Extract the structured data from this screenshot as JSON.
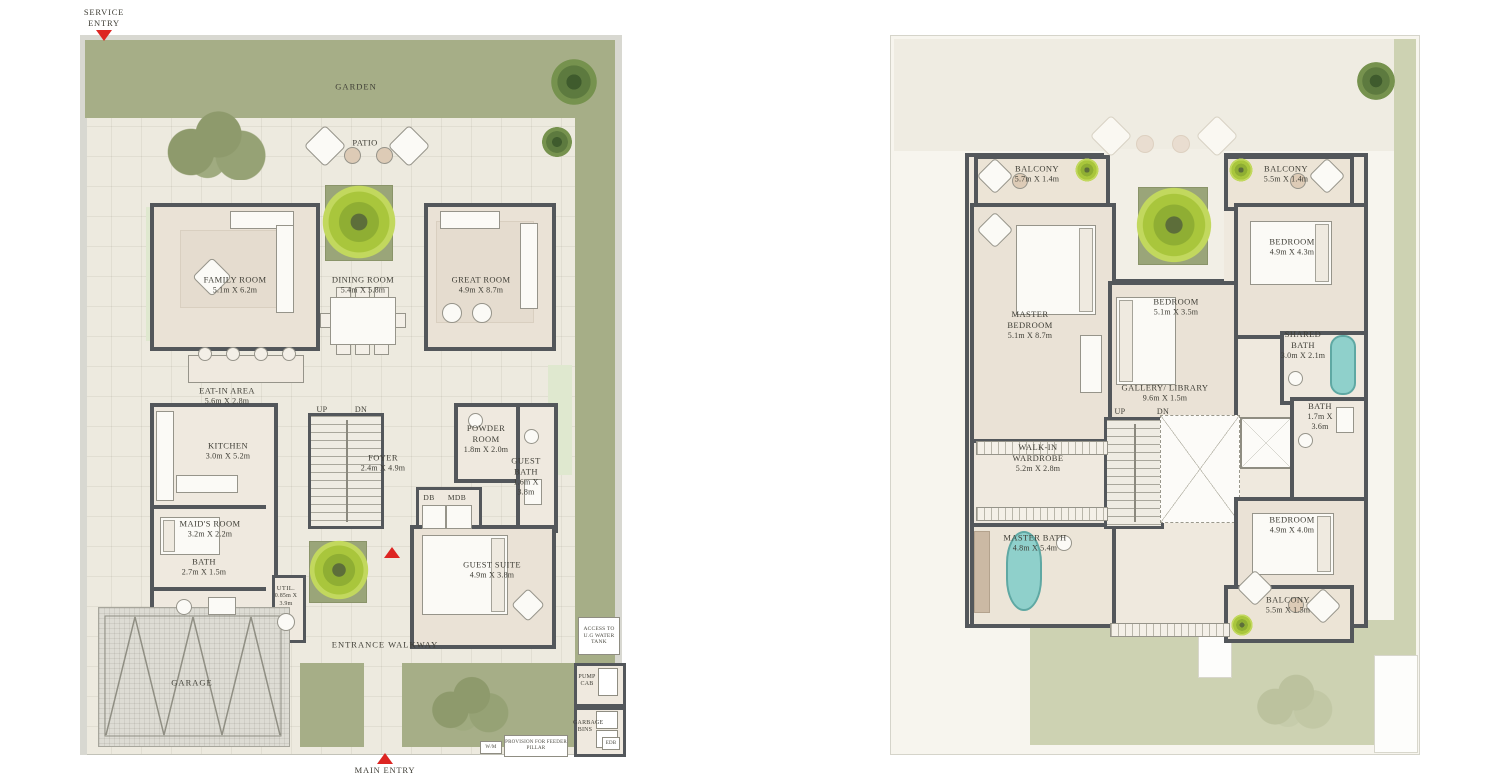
{
  "palette": {
    "garden_green": "#a6ae87",
    "pale_green": "#cdd2b2",
    "window_mint": "#dfe8cf",
    "floor_cream": "#edeadf",
    "room_beige": "#eae2d6",
    "wall_dark": "#53575b",
    "entry_red": "#dd2522",
    "tub_teal": "#8fd0cb",
    "tree_bright": "#a9c63c",
    "text_ink": "#3e3d35"
  },
  "ground_floor": {
    "entries": {
      "service": "SERVICE ENTRY",
      "main": "MAIN ENTRY"
    },
    "zones": {
      "garden": "GARDEN",
      "patio": "PATIO",
      "walkway": "ENTRANCE WALKWAY",
      "garage": "GARAGE"
    },
    "stairs": {
      "up": "UP",
      "dn": "DN"
    },
    "panels": {
      "db": "DB",
      "mdb": "MDB"
    },
    "services": {
      "water_tank": "ACCESS TO U.G WATER TANK",
      "pump": "PUMP CAB",
      "garbage": "GARBAGE BINS",
      "feeder": "PROVISION FOR FEEDER PILLAR",
      "wm": "W/M",
      "edb": "EDB"
    },
    "rooms": [
      {
        "name": "FAMILY ROOM",
        "dims": "5.1m X 6.2m"
      },
      {
        "name": "DINING ROOM",
        "dims": "5.4m X 5.8m"
      },
      {
        "name": "GREAT ROOM",
        "dims": "4.9m X 8.7m"
      },
      {
        "name": "EAT-IN AREA",
        "dims": "5.6m X 2.8m"
      },
      {
        "name": "KITCHEN",
        "dims": "3.0m X 5.2m"
      },
      {
        "name": "FOYER",
        "dims": "2.4m X 4.9m"
      },
      {
        "name": "POWDER ROOM",
        "dims": "1.8m X 2.0m"
      },
      {
        "name": "GUEST BATH",
        "dims": "1.6m X 3.8m"
      },
      {
        "name": "MAID'S ROOM",
        "dims": "3.2m X 2.2m"
      },
      {
        "name": "BATH",
        "dims": "2.7m X 1.5m"
      },
      {
        "name": "UTIL.",
        "dims": "0.85m X 3.9m"
      },
      {
        "name": "GUEST SUITE",
        "dims": "4.9m X 3.8m"
      }
    ]
  },
  "first_floor": {
    "stairs": {
      "up": "UP",
      "dn": "DN"
    },
    "rooms": [
      {
        "name": "BALCONY",
        "dims": "5.7m X 1.4m"
      },
      {
        "name": "BALCONY",
        "dims": "5.5m X 1.4m"
      },
      {
        "name": "MASTER BEDROOM",
        "dims": "5.1m X 8.7m"
      },
      {
        "name": "BEDROOM",
        "dims": "5.1m X 3.5m"
      },
      {
        "name": "BEDROOM",
        "dims": "4.9m X 4.3m"
      },
      {
        "name": "SHARED BATH",
        "dims": "3.0m X 2.1m"
      },
      {
        "name": "GALLERY/ LIBRARY",
        "dims": "9.6m X 1.5m"
      },
      {
        "name": "BATH",
        "dims": "1.7m X 3.6m"
      },
      {
        "name": "WALK-IN WARDROBE",
        "dims": "5.2m X 2.8m"
      },
      {
        "name": "MASTER BATH",
        "dims": "4.8m X 5.4m"
      },
      {
        "name": "BEDROOM",
        "dims": "4.9m X 4.0m"
      },
      {
        "name": "BALCONY",
        "dims": "5.5m X 1.5m"
      }
    ]
  }
}
